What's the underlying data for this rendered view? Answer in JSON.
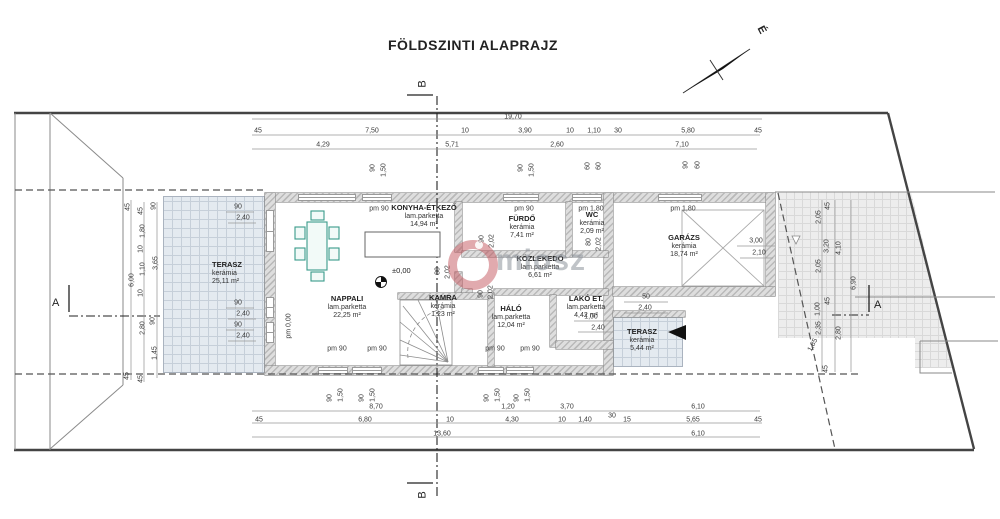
{
  "title": "FÖLDSZINTI ALAPRAJZ",
  "north": {
    "label": "É"
  },
  "watermark": {
    "text": "miosz"
  },
  "level_marker": "±0,00",
  "section_markers": [
    {
      "id": "B-top",
      "label": "B"
    },
    {
      "id": "B-bottom",
      "label": "B"
    },
    {
      "id": "A-left",
      "label": "A"
    },
    {
      "id": "A-right",
      "label": "A"
    }
  ],
  "rooms": [
    {
      "name": "TERASZ",
      "material": "kerámia",
      "area": "25,11 m²",
      "x": 212,
      "y": 261,
      "align": "left"
    },
    {
      "name": "NAPPALI",
      "material": "lam.parketta",
      "area": "22,25 m²",
      "x": 347,
      "y": 295
    },
    {
      "name": "KONYHA-ÉTKEZŐ",
      "material": "lam.parketta",
      "area": "14,94 m²",
      "x": 424,
      "y": 204
    },
    {
      "name": "FÜRDŐ",
      "material": "kerámia",
      "area": "7,41 m²",
      "x": 522,
      "y": 215
    },
    {
      "name": "WC",
      "material": "kerámia",
      "area": "2,09 m²",
      "x": 592,
      "y": 211
    },
    {
      "name": "KÖZLEKEDŐ",
      "material": "lam.parketta",
      "area": "6,61 m²",
      "x": 540,
      "y": 255
    },
    {
      "name": "KAMRA",
      "material": "kerámia",
      "area": "1,23 m²",
      "x": 443,
      "y": 294
    },
    {
      "name": "HÁLÓ",
      "material": "lam.parketta",
      "area": "12,04 m²",
      "x": 511,
      "y": 305
    },
    {
      "name": "LAKÓ ET.",
      "material": "lam.parketta",
      "area": "4,42 m²",
      "x": 586,
      "y": 295
    },
    {
      "name": "GARÁZS",
      "material": "kerámia",
      "area": "18,74 m²",
      "x": 684,
      "y": 234
    },
    {
      "name": "TERASZ",
      "material": "kerámia",
      "area": "5,44 m²",
      "x": 642,
      "y": 328
    }
  ],
  "dims": [
    {
      "t": "19,70",
      "x": 513,
      "y": 117
    },
    {
      "t": "45",
      "x": 258,
      "y": 131
    },
    {
      "t": "7,50",
      "x": 372,
      "y": 131
    },
    {
      "t": "10",
      "x": 465,
      "y": 131
    },
    {
      "t": "3,90",
      "x": 525,
      "y": 131
    },
    {
      "t": "10",
      "x": 570,
      "y": 131
    },
    {
      "t": "1,10",
      "x": 594,
      "y": 131
    },
    {
      "t": "30",
      "x": 618,
      "y": 131
    },
    {
      "t": "5,80",
      "x": 688,
      "y": 131
    },
    {
      "t": "45",
      "x": 758,
      "y": 131
    },
    {
      "t": "4,29",
      "x": 323,
      "y": 145
    },
    {
      "t": "5,71",
      "x": 452,
      "y": 145
    },
    {
      "t": "2,60",
      "x": 557,
      "y": 145
    },
    {
      "t": "7,10",
      "x": 682,
      "y": 145
    },
    {
      "t": "90",
      "x": 373,
      "y": 168,
      "r": 1
    },
    {
      "t": "1,50",
      "x": 384,
      "y": 170,
      "r": 1
    },
    {
      "t": "90",
      "x": 521,
      "y": 168,
      "r": 1
    },
    {
      "t": "1,50",
      "x": 532,
      "y": 170,
      "r": 1
    },
    {
      "t": "60",
      "x": 588,
      "y": 166,
      "r": 1
    },
    {
      "t": "60",
      "x": 599,
      "y": 166,
      "r": 1
    },
    {
      "t": "90",
      "x": 686,
      "y": 165,
      "r": 1
    },
    {
      "t": "60",
      "x": 698,
      "y": 165,
      "r": 1
    },
    {
      "t": "45",
      "x": 128,
      "y": 207,
      "r": 1
    },
    {
      "t": "6,00",
      "x": 132,
      "y": 280,
      "r": 1
    },
    {
      "t": "45",
      "x": 127,
      "y": 376,
      "r": 1
    },
    {
      "t": "45",
      "x": 141,
      "y": 211,
      "r": 1
    },
    {
      "t": "1,80",
      "x": 143,
      "y": 231,
      "r": 1
    },
    {
      "t": "10",
      "x": 141,
      "y": 249,
      "r": 1
    },
    {
      "t": "1,10",
      "x": 143,
      "y": 269,
      "r": 1
    },
    {
      "t": "10",
      "x": 141,
      "y": 293,
      "r": 1
    },
    {
      "t": "2,80",
      "x": 143,
      "y": 328,
      "r": 1
    },
    {
      "t": "45",
      "x": 141,
      "y": 379,
      "r": 1
    },
    {
      "t": "90",
      "x": 154,
      "y": 206,
      "r": 1
    },
    {
      "t": "3,65",
      "x": 156,
      "y": 263,
      "r": 1
    },
    {
      "t": "90",
      "x": 153,
      "y": 321,
      "r": 1
    },
    {
      "t": "1,45",
      "x": 155,
      "y": 353,
      "r": 1
    },
    {
      "t": "45",
      "x": 828,
      "y": 206,
      "r": 1
    },
    {
      "t": "2,05",
      "x": 819,
      "y": 217,
      "r": 1
    },
    {
      "t": "3,20",
      "x": 827,
      "y": 246,
      "r": 1
    },
    {
      "t": "4,10",
      "x": 839,
      "y": 248,
      "r": 1
    },
    {
      "t": "2,05",
      "x": 819,
      "y": 266,
      "r": 1
    },
    {
      "t": "6,90",
      "x": 854,
      "y": 283,
      "r": 1
    },
    {
      "t": "45",
      "x": 828,
      "y": 301,
      "r": 1
    },
    {
      "t": "1,00",
      "x": 818,
      "y": 309,
      "r": 1
    },
    {
      "t": "2,35",
      "x": 819,
      "y": 328,
      "r": 1
    },
    {
      "t": "2,80",
      "x": 839,
      "y": 333,
      "r": 1
    },
    {
      "t": "1,85",
      "x": 813,
      "y": 345,
      "r": 2
    },
    {
      "t": "45",
      "x": 826,
      "y": 369,
      "r": 1
    },
    {
      "t": "90",
      "x": 330,
      "y": 398,
      "r": 1
    },
    {
      "t": "1,50",
      "x": 341,
      "y": 395,
      "r": 1
    },
    {
      "t": "90",
      "x": 362,
      "y": 398,
      "r": 1
    },
    {
      "t": "1,50",
      "x": 373,
      "y": 395,
      "r": 1
    },
    {
      "t": "90",
      "x": 487,
      "y": 398,
      "r": 1
    },
    {
      "t": "1,50",
      "x": 498,
      "y": 395,
      "r": 1
    },
    {
      "t": "90",
      "x": 517,
      "y": 398,
      "r": 1
    },
    {
      "t": "1,50",
      "x": 528,
      "y": 395,
      "r": 1
    },
    {
      "t": "8,70",
      "x": 376,
      "y": 407
    },
    {
      "t": "1,20",
      "x": 508,
      "y": 407
    },
    {
      "t": "3,70",
      "x": 567,
      "y": 407
    },
    {
      "t": "6,10",
      "x": 698,
      "y": 407
    },
    {
      "t": "45",
      "x": 259,
      "y": 420
    },
    {
      "t": "6,80",
      "x": 365,
      "y": 420
    },
    {
      "t": "10",
      "x": 450,
      "y": 420
    },
    {
      "t": "4,30",
      "x": 512,
      "y": 420
    },
    {
      "t": "10",
      "x": 562,
      "y": 420
    },
    {
      "t": "1,40",
      "x": 585,
      "y": 420
    },
    {
      "t": "30",
      "x": 612,
      "y": 416
    },
    {
      "t": "15",
      "x": 627,
      "y": 420
    },
    {
      "t": "5,65",
      "x": 693,
      "y": 420
    },
    {
      "t": "45",
      "x": 758,
      "y": 420
    },
    {
      "t": "13,60",
      "x": 442,
      "y": 434
    },
    {
      "t": "6,10",
      "x": 698,
      "y": 434
    },
    {
      "t": "pm 90",
      "x": 379,
      "y": 209
    },
    {
      "t": "pm 90",
      "x": 524,
      "y": 209
    },
    {
      "t": "pm 1,80",
      "x": 591,
      "y": 209
    },
    {
      "t": "pm 1,80",
      "x": 683,
      "y": 209
    },
    {
      "t": "pm 90",
      "x": 337,
      "y": 349
    },
    {
      "t": "pm 90",
      "x": 377,
      "y": 349
    },
    {
      "t": "pm 90",
      "x": 495,
      "y": 349
    },
    {
      "t": "pm 90",
      "x": 530,
      "y": 349
    },
    {
      "t": "pm 0,00",
      "x": 289,
      "y": 326,
      "r": 1
    },
    {
      "t": "80",
      "x": 438,
      "y": 271,
      "r": 1
    },
    {
      "t": "2,02",
      "x": 448,
      "y": 272,
      "r": 1
    },
    {
      "t": "90",
      "x": 481,
      "y": 294,
      "r": 1
    },
    {
      "t": "2,02",
      "x": 491,
      "y": 292,
      "r": 1
    },
    {
      "t": "90",
      "x": 482,
      "y": 239,
      "r": 1
    },
    {
      "t": "2,02",
      "x": 492,
      "y": 241,
      "r": 1
    },
    {
      "t": "80",
      "x": 589,
      "y": 242,
      "r": 1
    },
    {
      "t": "2,02",
      "x": 599,
      "y": 244,
      "r": 1
    },
    {
      "t": "90",
      "x": 238,
      "y": 207
    },
    {
      "t": "2,40",
      "x": 243,
      "y": 218
    },
    {
      "t": "90",
      "x": 238,
      "y": 303
    },
    {
      "t": "2,40",
      "x": 243,
      "y": 314
    },
    {
      "t": "90",
      "x": 238,
      "y": 325
    },
    {
      "t": "2,40",
      "x": 243,
      "y": 336
    },
    {
      "t": "3,00",
      "x": 756,
      "y": 241
    },
    {
      "t": "2,10",
      "x": 759,
      "y": 253
    },
    {
      "t": "50",
      "x": 646,
      "y": 297
    },
    {
      "t": "2,40",
      "x": 645,
      "y": 308
    },
    {
      "t": "1,00",
      "x": 591,
      "y": 317
    },
    {
      "t": "2,40",
      "x": 598,
      "y": 328
    }
  ]
}
